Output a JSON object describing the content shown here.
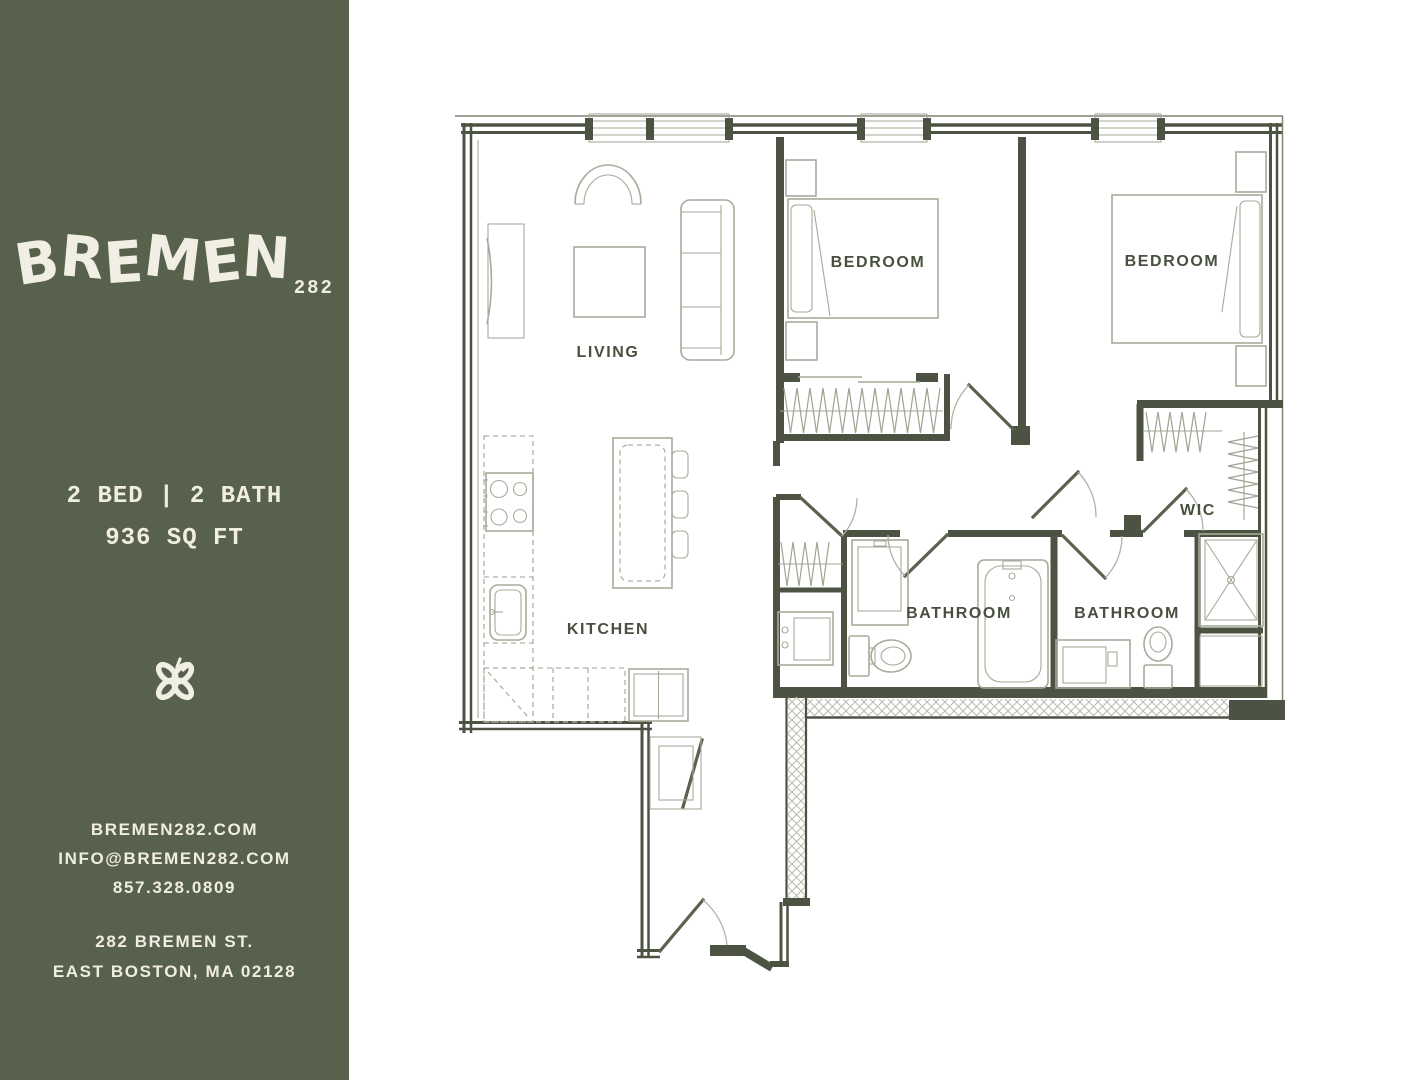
{
  "sidebar": {
    "logo": {
      "name": "BREMEN",
      "number": "282"
    },
    "specs": {
      "beds_baths": "2 BED | 2 BATH",
      "area": "936 SQ FT"
    },
    "contact": {
      "website": "BREMEN282.COM",
      "email": "INFO@BREMEN282.COM",
      "phone": "857.328.0809"
    },
    "address": {
      "line1": "282 BREMEN ST.",
      "line2": "EAST BOSTON, MA 02128"
    },
    "colors": {
      "background": "#57614B",
      "text": "#F0EDE2"
    }
  },
  "floorplan": {
    "rooms": {
      "living": "LIVING",
      "bedroom1": "BEDROOM",
      "bedroom2": "BEDROOM",
      "kitchen": "KITCHEN",
      "bathroom1": "BATHROOM",
      "bathroom2": "BATHROOM",
      "wic": "WIC"
    },
    "colors": {
      "wall": "#4C5342",
      "furniture": "#A6AB9A",
      "label": "#49503F"
    }
  }
}
